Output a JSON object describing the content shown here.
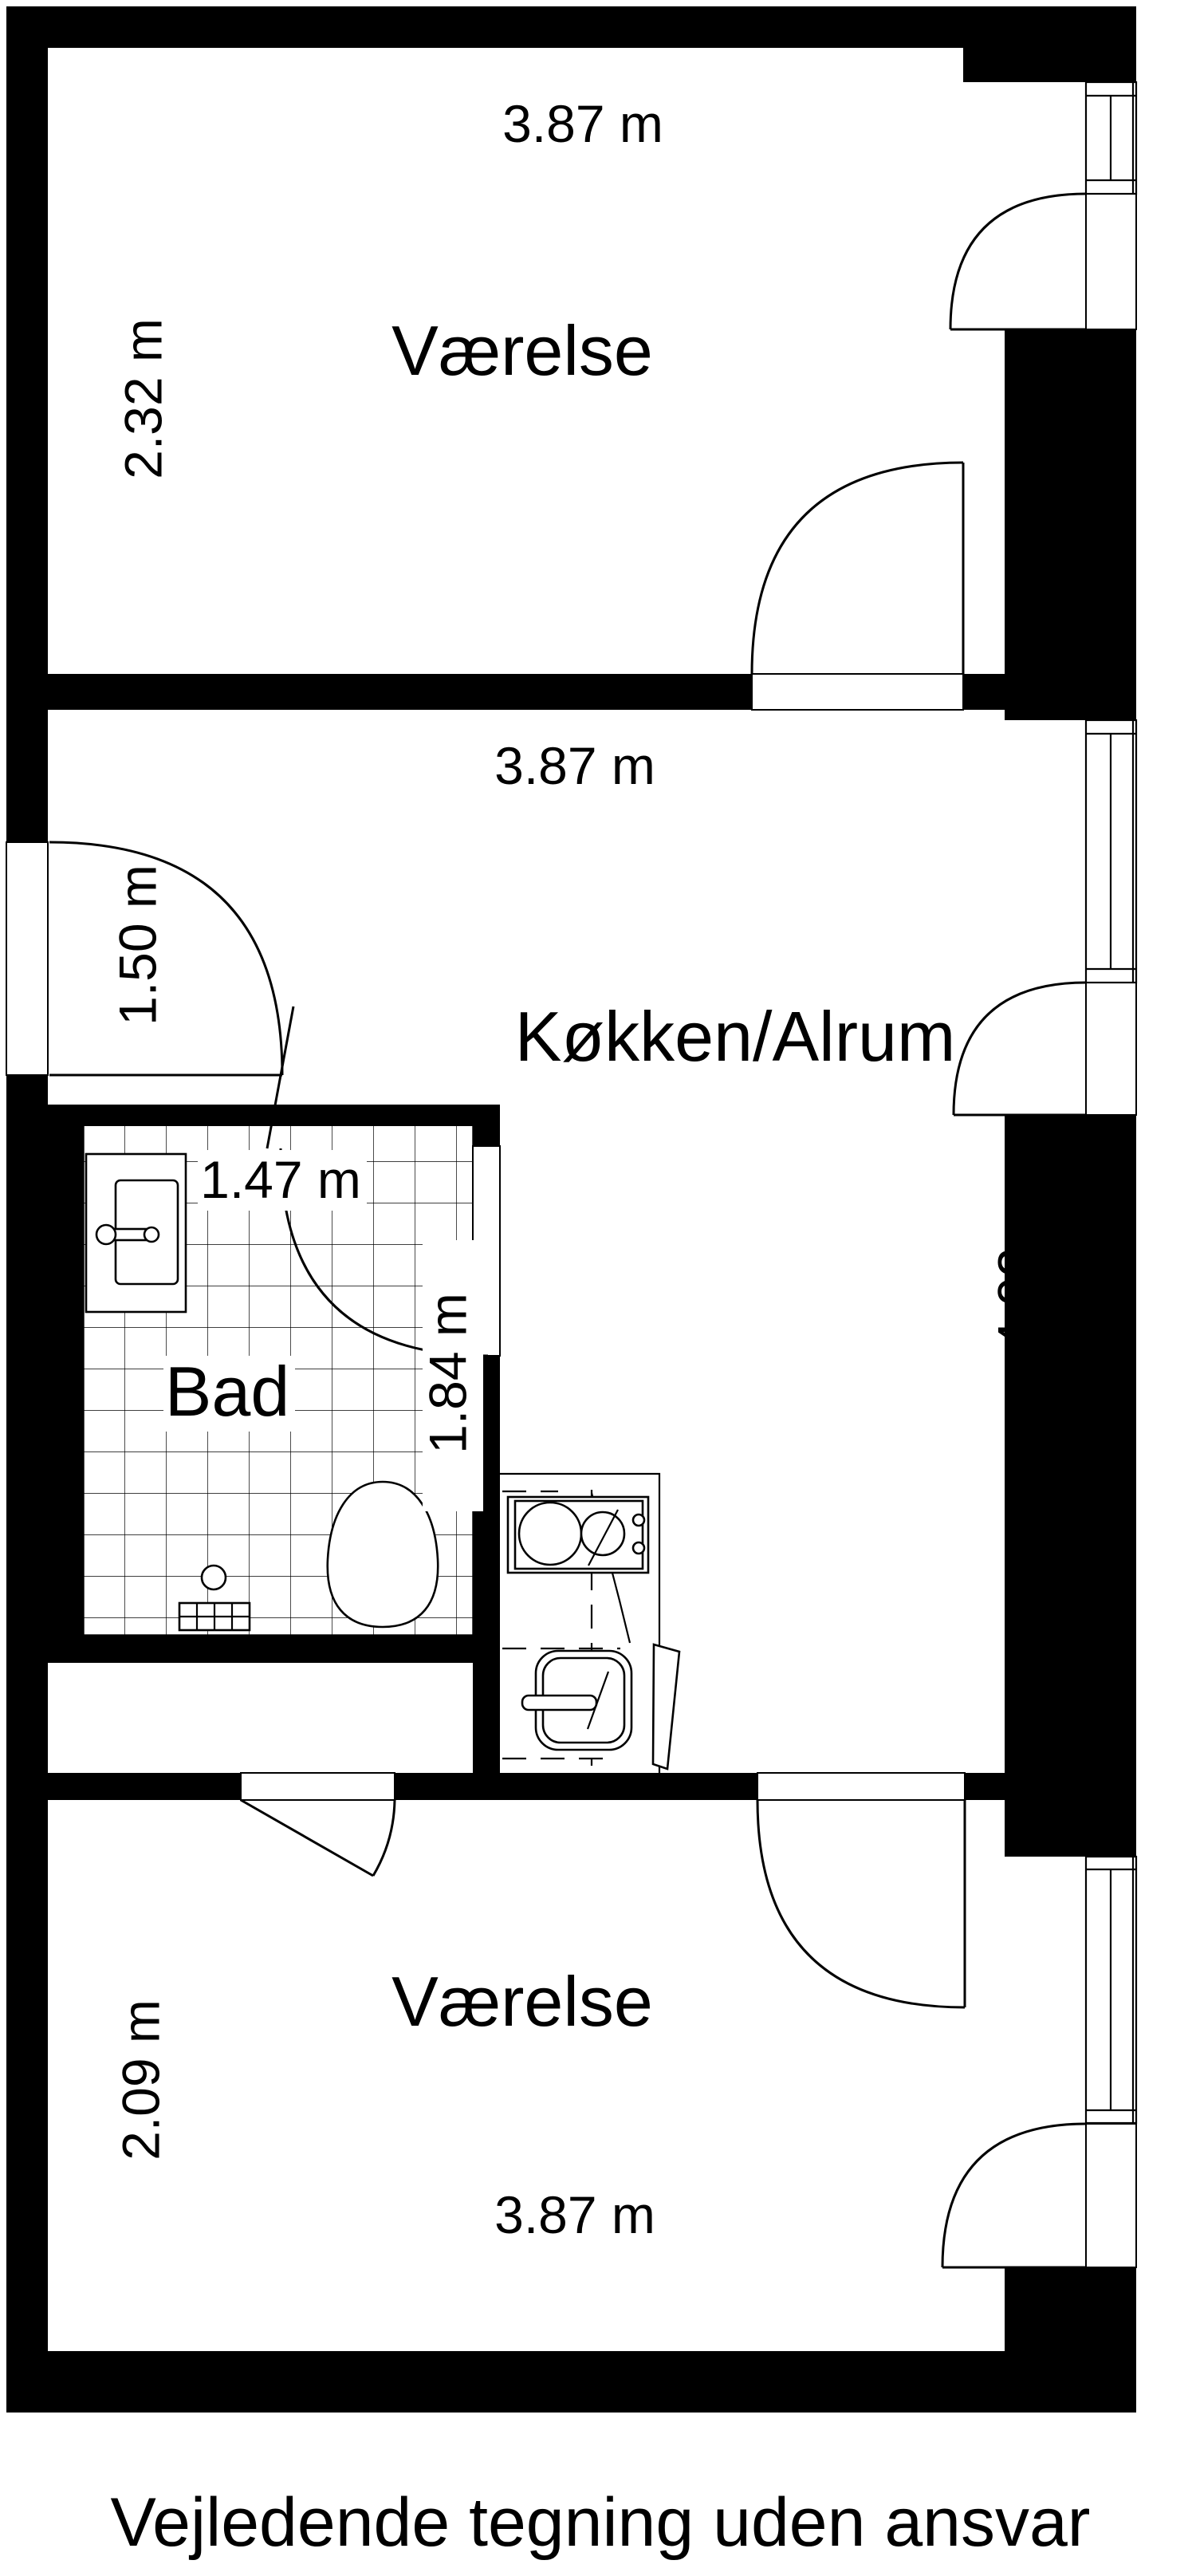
{
  "plan": {
    "caption": "Vejledende tegning uden ansvar",
    "colors": {
      "wall": "#000000",
      "line": "#000000",
      "background": "#ffffff"
    },
    "rooms": {
      "room_top": {
        "name": "Værelse",
        "width_label": "3.87 m",
        "height_label": "2.32 m"
      },
      "kitchen": {
        "name": "Køkken/Alrum",
        "width_label": "3.87 m",
        "height_label": "4.02 m",
        "entry_label": "1.50 m"
      },
      "bathroom": {
        "name": "Bad",
        "width_label": "1.47 m",
        "height_label": "1.84 m"
      },
      "room_bottom": {
        "name": "Værelse",
        "width_label": "3.87 m",
        "height_label": "2.09 m"
      }
    },
    "fixtures": {
      "bathroom_sink": "håndvask",
      "toilet": "toilet",
      "floor_drain": "gulvafløb",
      "kitchen_sink": "køkkenvask",
      "washing_machine": "hvidevare"
    }
  }
}
